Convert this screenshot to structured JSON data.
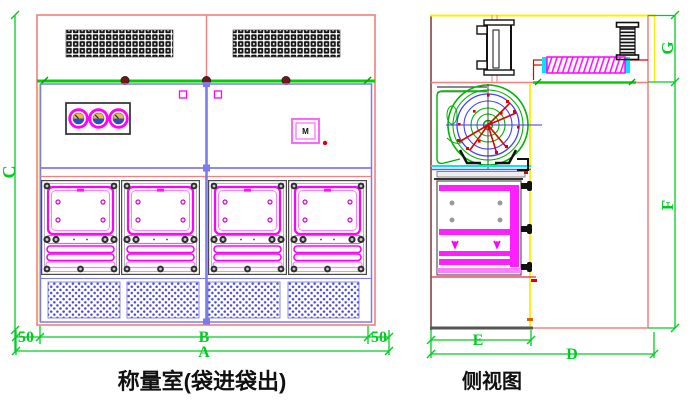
{
  "front_view": {
    "title": "称量室(袋进袋出)",
    "control_box_label": "M",
    "dims": {
      "total_width": "A",
      "inner_width": "B",
      "height": "C",
      "margin_left": "50",
      "margin_right": "50"
    }
  },
  "side_view": {
    "title": "侧视图",
    "dims": {
      "total_depth": "D",
      "chamber_depth": "E",
      "body_height": "F",
      "top_height": "G"
    }
  },
  "colors": {
    "outline_red": "#f57e7e",
    "dimension_green": "#00cc22",
    "panel_magenta": "#ff00ff",
    "structure_blue": "#7b7bf0",
    "accent_yellow": "#ffee00",
    "grille_black": "#141414",
    "perforation_blue": "#4848d8",
    "fan_green": "#00b400",
    "fan_red": "#e00000"
  }
}
